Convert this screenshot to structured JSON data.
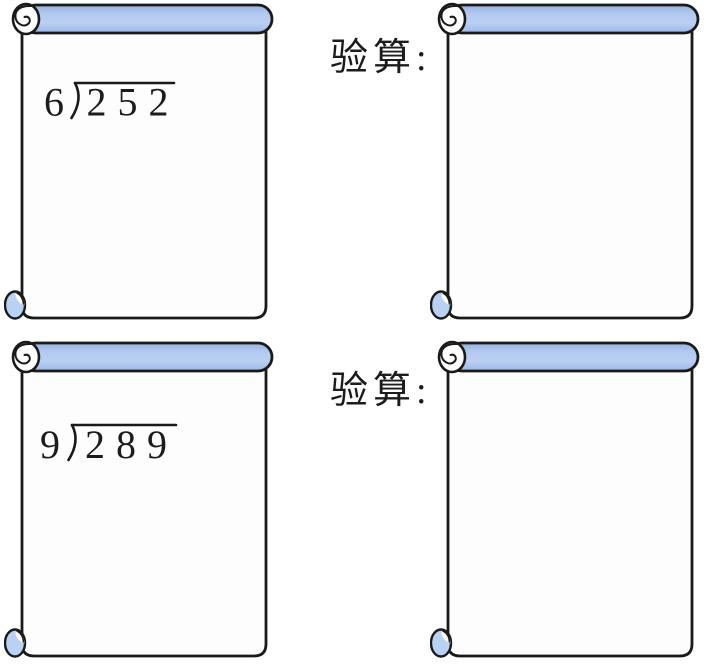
{
  "colors": {
    "scroll_blue": "#aac5ef",
    "scroll_blue_shadow": "#96b1de",
    "curl_blue": "#b9d2f3",
    "paper": "#fdfdfd",
    "ink": "#1a1a1a",
    "text": "#1c1c1c"
  },
  "rows": [
    {
      "problem": {
        "divisor": "6",
        "dividend": "252"
      },
      "check_label": "验算:"
    },
    {
      "problem": {
        "divisor": "9",
        "dividend": "289"
      },
      "check_label": "验算:"
    }
  ]
}
